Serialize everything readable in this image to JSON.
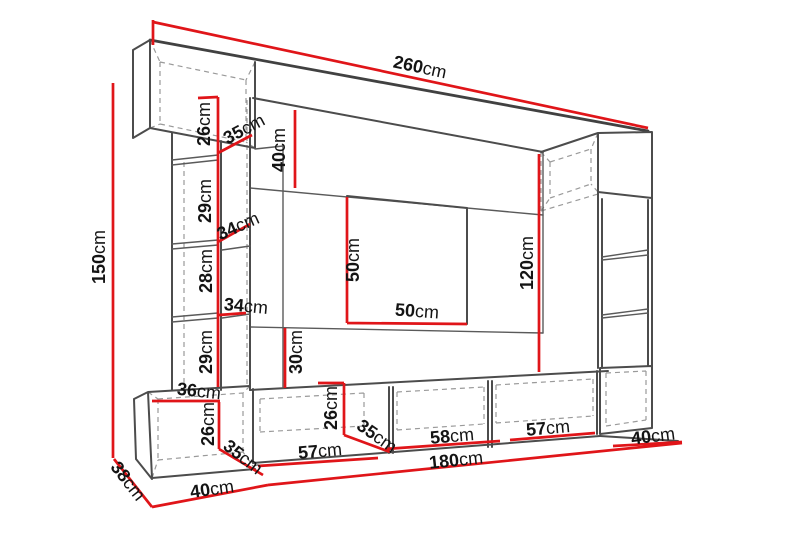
{
  "diagram": {
    "unit_label": "cm",
    "colors": {
      "dimension_line": "#e01519",
      "outline": "#4c4c4c",
      "hidden_line": "#9a9a9a",
      "label_text": "#141414",
      "background": "#ffffff"
    },
    "font_size": 18,
    "dimensions": [
      {
        "id": "total-width",
        "value": "260",
        "unit": "cm",
        "x": 420,
        "y": 67,
        "rot": 12
      },
      {
        "id": "total-height",
        "value": "150",
        "unit": "cm",
        "x": 99,
        "y": 257,
        "rot": -90
      },
      {
        "id": "top-cabinet-height",
        "value": "26",
        "unit": "cm",
        "x": 204,
        "y": 124,
        "rot": -90
      },
      {
        "id": "top-cabinet-depth",
        "value": "35",
        "unit": "cm",
        "x": 244,
        "y": 129,
        "rot": -28
      },
      {
        "id": "top-panel-height",
        "value": "40",
        "unit": "cm",
        "x": 279,
        "y": 150,
        "rot": -90
      },
      {
        "id": "left-section-1-height",
        "value": "29",
        "unit": "cm",
        "x": 205,
        "y": 201,
        "rot": -90
      },
      {
        "id": "left-shelf-1-width",
        "value": "34",
        "unit": "cm",
        "x": 238,
        "y": 226,
        "rot": -24
      },
      {
        "id": "left-section-2-height",
        "value": "28",
        "unit": "cm",
        "x": 206,
        "y": 271,
        "rot": -90
      },
      {
        "id": "left-shelf-2-width",
        "value": "34",
        "unit": "cm",
        "x": 246,
        "y": 306,
        "rot": 5
      },
      {
        "id": "tv-recess-height",
        "value": "50",
        "unit": "cm",
        "x": 353,
        "y": 260,
        "rot": -90
      },
      {
        "id": "tv-recess-width",
        "value": "50",
        "unit": "cm",
        "x": 417,
        "y": 311,
        "rot": 4
      },
      {
        "id": "right-panel-height",
        "value": "120",
        "unit": "cm",
        "x": 527,
        "y": 263,
        "rot": -90
      },
      {
        "id": "left-section-3-height",
        "value": "29",
        "unit": "cm",
        "x": 206,
        "y": 352,
        "rot": -90
      },
      {
        "id": "lower-gap-height",
        "value": "30",
        "unit": "cm",
        "x": 296,
        "y": 352,
        "rot": -90
      },
      {
        "id": "base-left-top-width",
        "value": "36",
        "unit": "cm",
        "x": 199,
        "y": 391,
        "rot": 6
      },
      {
        "id": "base-left-height",
        "value": "26",
        "unit": "cm",
        "x": 208,
        "y": 424,
        "rot": -90
      },
      {
        "id": "base-left-depth",
        "value": "35",
        "unit": "cm",
        "x": 243,
        "y": 457,
        "rot": 38
      },
      {
        "id": "base-mid-height",
        "value": "26",
        "unit": "cm",
        "x": 331,
        "y": 408,
        "rot": -90
      },
      {
        "id": "base-mid-depth",
        "value": "35",
        "unit": "cm",
        "x": 377,
        "y": 436,
        "rot": 35
      },
      {
        "id": "base-compartment-1",
        "value": "57",
        "unit": "cm",
        "x": 320,
        "y": 451,
        "rot": -5
      },
      {
        "id": "base-compartment-2",
        "value": "58",
        "unit": "cm",
        "x": 452,
        "y": 436,
        "rot": -5
      },
      {
        "id": "base-compartment-3",
        "value": "57",
        "unit": "cm",
        "x": 548,
        "y": 428,
        "rot": -5
      },
      {
        "id": "base-right-width",
        "value": "40",
        "unit": "cm",
        "x": 653,
        "y": 436,
        "rot": -7
      },
      {
        "id": "base-total-width",
        "value": "180",
        "unit": "cm",
        "x": 456,
        "y": 460,
        "rot": -6
      },
      {
        "id": "unit-depth",
        "value": "38",
        "unit": "cm",
        "x": 128,
        "y": 481,
        "rot": 52
      },
      {
        "id": "base-left-outer-width",
        "value": "40",
        "unit": "cm",
        "x": 212,
        "y": 489,
        "rot": -8
      }
    ]
  }
}
